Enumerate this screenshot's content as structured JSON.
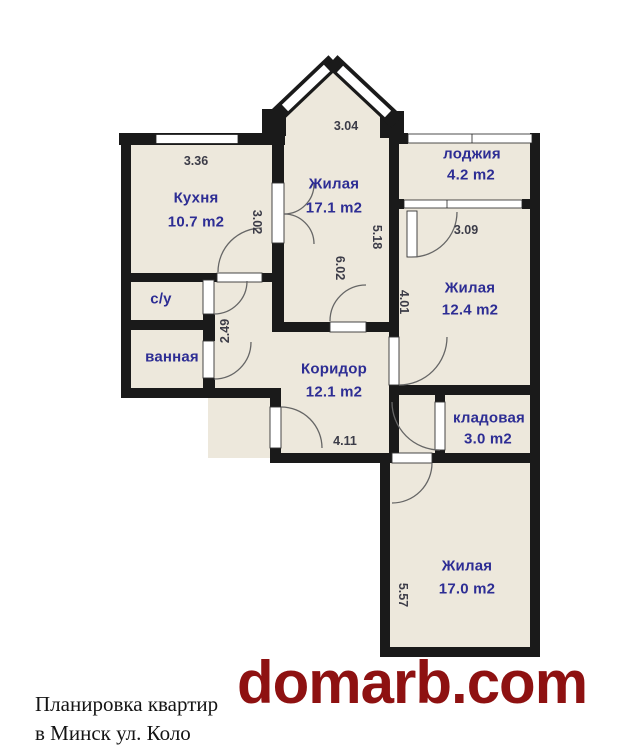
{
  "plan": {
    "rooms": [
      {
        "name": "Кухня",
        "area": "10.7 m2"
      },
      {
        "name": "Жилая",
        "area": "17.1 m2"
      },
      {
        "name": "лоджия",
        "area": "4.2 m2"
      },
      {
        "name": "Жилая",
        "area": "12.4 m2"
      },
      {
        "name": "с/у",
        "area": ""
      },
      {
        "name": "ванная",
        "area": ""
      },
      {
        "name": "Коридор",
        "area": "12.1 m2"
      },
      {
        "name": "кладовая",
        "area": "3.0 m2"
      },
      {
        "name": "Жилая",
        "area": "17.0 m2"
      }
    ],
    "dimensions": [
      {
        "value": "3.36"
      },
      {
        "value": "3.02"
      },
      {
        "value": "3.04"
      },
      {
        "value": "5.18"
      },
      {
        "value": "6.02"
      },
      {
        "value": "3.09"
      },
      {
        "value": "4.01"
      },
      {
        "value": "2.49"
      },
      {
        "value": "4.11"
      },
      {
        "value": "5.57"
      }
    ]
  },
  "caption": {
    "line1": "Планировка квартир",
    "line2": "в Минск ул. Коло"
  },
  "watermark": {
    "text": "domarb.com"
  },
  "colors": {
    "wall": "#1a1a1a",
    "floor": "#ede8dc",
    "room_label": "#2d2d94",
    "dimension_label": "#3c3c48",
    "watermark_red": "#8e1111",
    "background": "#ffffff"
  }
}
